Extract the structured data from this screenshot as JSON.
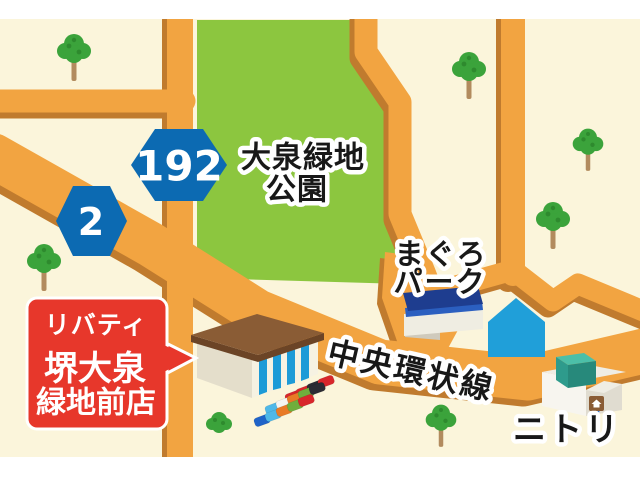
{
  "canvas": {
    "background": "#FBF5DB",
    "frame_color": "#FFFFFF"
  },
  "park": {
    "name_line1": "大泉緑地",
    "name_line2": "公園",
    "color": "#8CC63F"
  },
  "roads": {
    "main_label": "中央環状線",
    "color": "#F2A441",
    "shadow_color": "#C07B2E"
  },
  "shields": {
    "route_192": "192",
    "route_2": "2",
    "color": "#0C6AB2",
    "number_color": "#FFFFFF"
  },
  "pois": {
    "maguro_line1": "まぐろ",
    "maguro_line2": "パーク",
    "nitori": "ニトリ"
  },
  "store_sign": {
    "line1": "リバティ",
    "line2": "堺大泉",
    "line3": "緑地前店",
    "bg_color": "#E7372B",
    "text_color": "#FFFFFF"
  }
}
